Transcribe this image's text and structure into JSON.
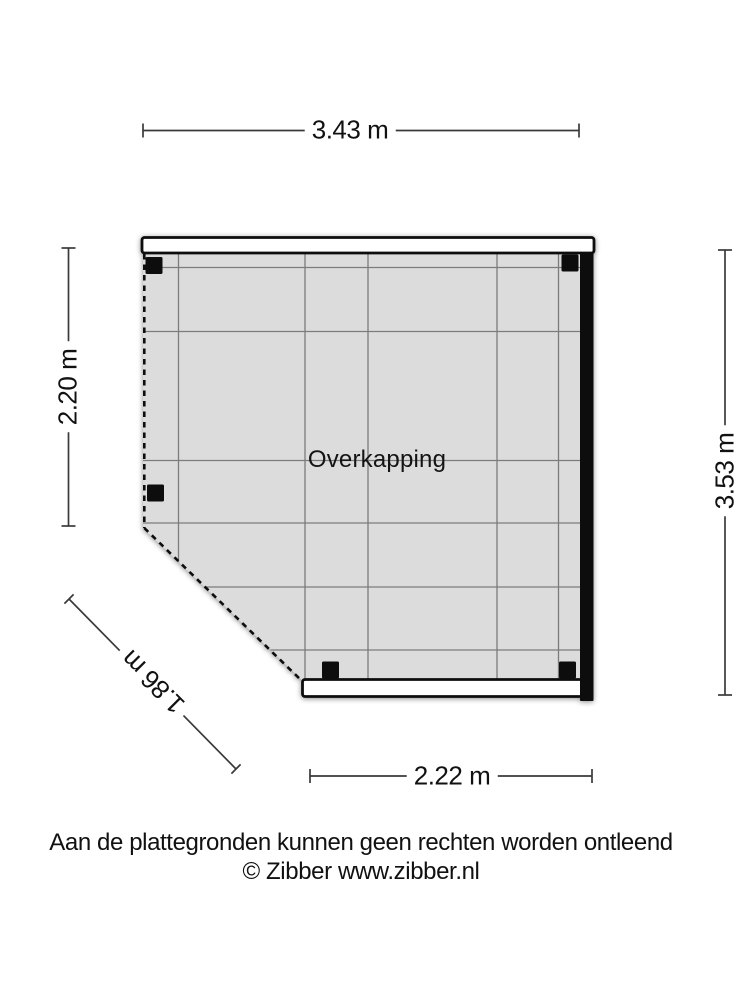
{
  "plan": {
    "room_label": "Overkapping",
    "dimensions": {
      "top": "3.43 m",
      "left": "2.20 m",
      "right": "3.53 m",
      "bottom": "2.22 m",
      "diagonal": "1.86 m"
    }
  },
  "footer": {
    "disclaimer": "Aan de plattegronden kunnen geen rechten worden ontleend",
    "copyright": "© Zibber www.zibber.nl"
  },
  "colors": {
    "floor_fill": "#dcdcdc",
    "grid_line": "#7b7b7b",
    "wall_black": "#0d0d0d",
    "wall_white": "#ffffff",
    "dimension_line": "#3a3a3a",
    "text": "#111111"
  }
}
